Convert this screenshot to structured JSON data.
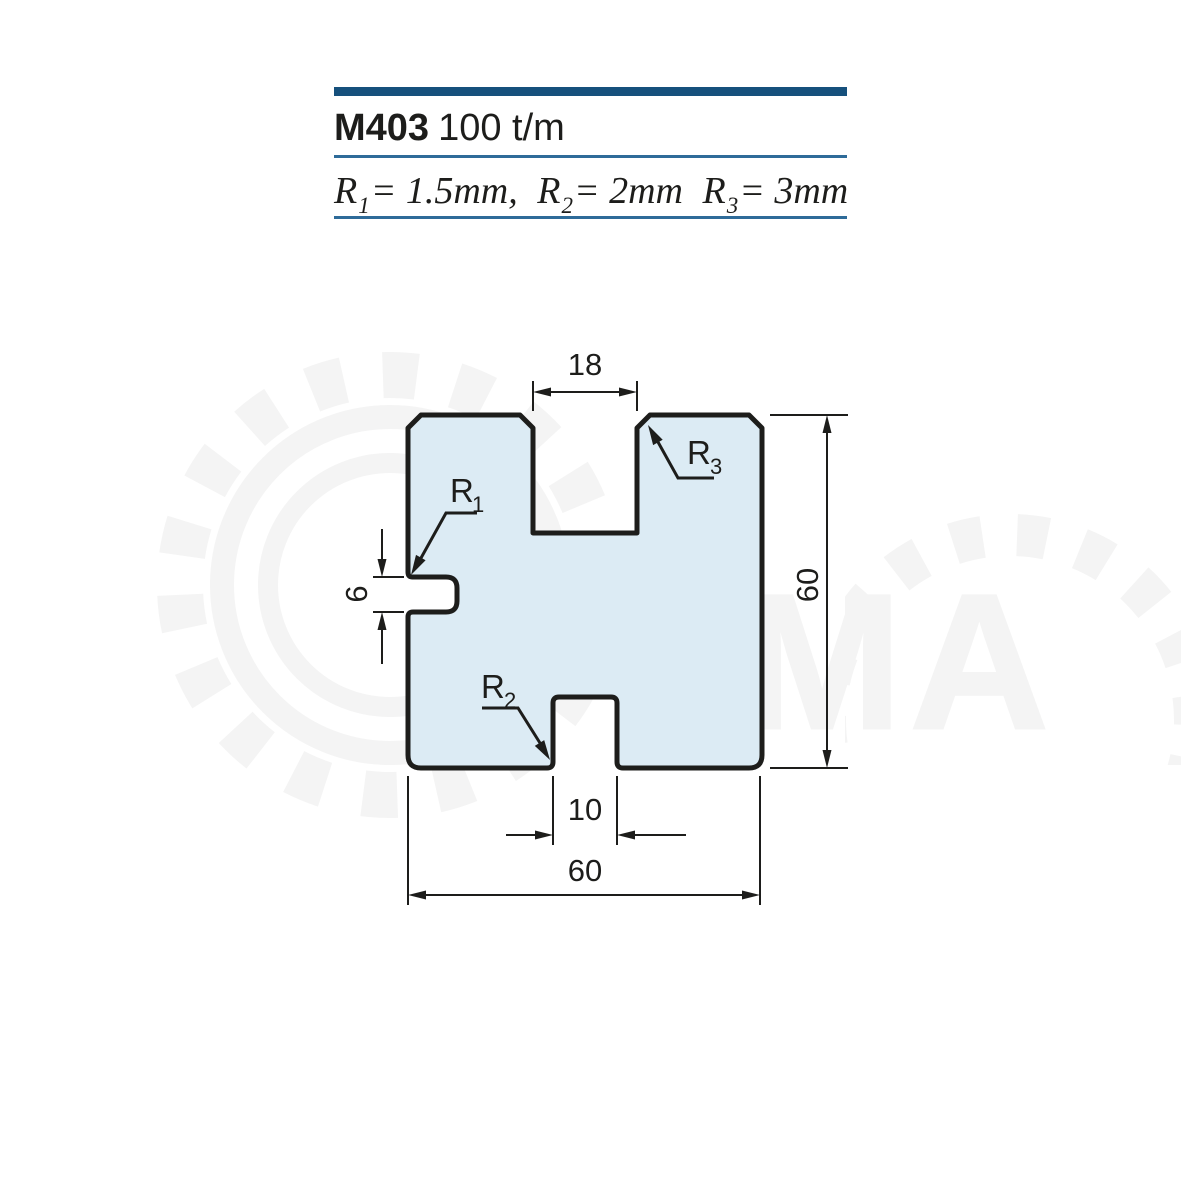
{
  "header": {
    "model": "M403",
    "capacity": "100 t/m",
    "formula": {
      "r1": {
        "base": "R",
        "sub": "1",
        "value": "= 1.5mm,"
      },
      "r2": {
        "base": "R",
        "sub": "2",
        "value": "= 2mm"
      },
      "r3": {
        "base": "R",
        "sub": "3",
        "value": "= 3mm"
      }
    }
  },
  "drawing": {
    "dimensions": {
      "top_slot_width": "18",
      "side_notch_height": "6",
      "overall_height": "60",
      "bottom_notch_width": "10",
      "overall_width": "60"
    },
    "radius_labels": {
      "r1": {
        "base": "R",
        "sub": "1"
      },
      "r2": {
        "base": "R",
        "sub": "2"
      },
      "r3": {
        "base": "R",
        "sub": "3"
      }
    },
    "colors": {
      "accent_bar": "#16507c",
      "rule_line": "#2e6b99",
      "profile_fill": "#dcebf4",
      "profile_stroke": "#1d1d1b"
    }
  },
  "watermark": {
    "letters": "MA"
  }
}
